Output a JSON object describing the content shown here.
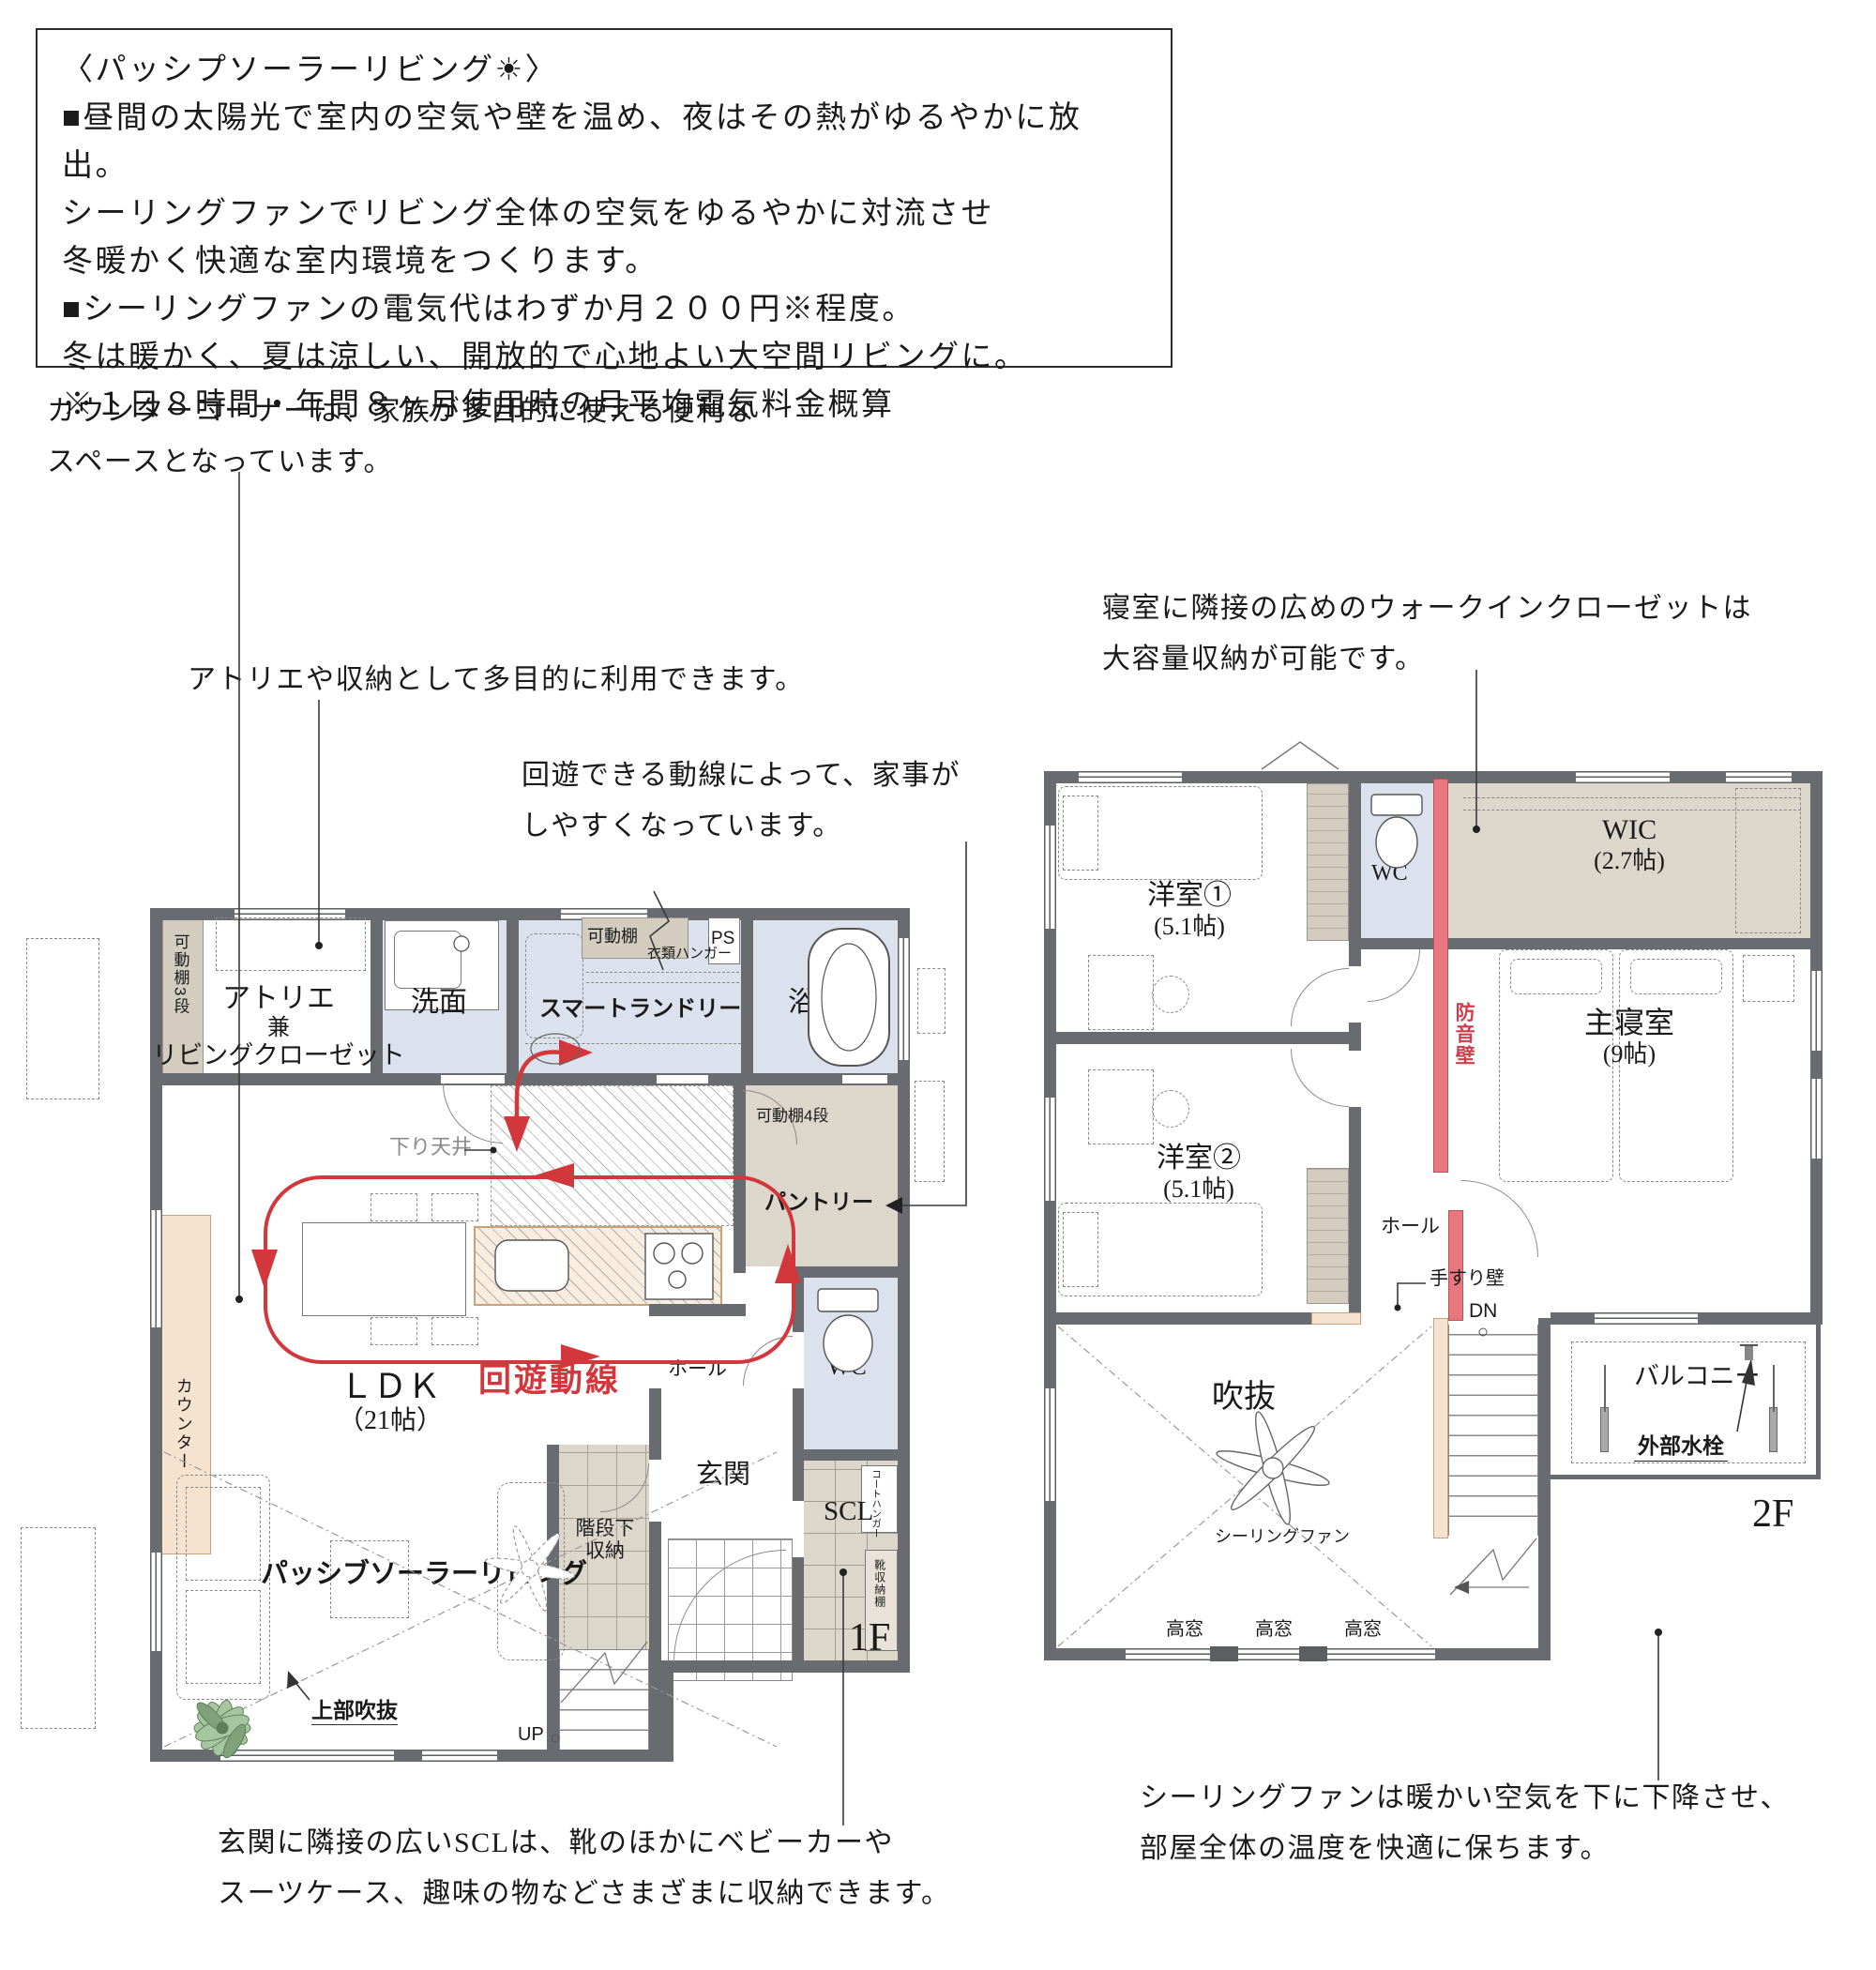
{
  "info_box": {
    "title": "〈パッシプソーラーリビング☀〉",
    "lines": [
      "■昼間の太陽光で室内の空気や壁を温め、夜はその熱がゆるやかに放出。",
      "シーリングファンでリビング全体の空気をゆるやかに対流させ",
      "冬暖かく快適な室内環境をつくります。",
      "■シーリングファンの電気代はわずか月２００円※程度。",
      "冬は暖かく、夏は涼しい、開放的で心地よい大空間リビングに。",
      "※１日８時間・年間８ヶ月使用時の月平均電気料金概算"
    ]
  },
  "annotations": {
    "counter": [
      "カウンターコーナーは、家族が多目的に使える便利な",
      "スペースとなっています。"
    ],
    "atelier": "アトリエや収納として多目的に利用できます。",
    "circulation": [
      "回遊できる動線によって、家事が",
      "しやすくなっています。"
    ],
    "wic": [
      "寝室に隣接の広めのウォークインクローゼットは",
      "大容量収納が可能です。"
    ],
    "scl": [
      "玄関に隣接の広いSCLは、靴のほかにベビーカーや",
      "スーツケース、趣味の物などさまざまに収納できます。"
    ],
    "fan": [
      "シーリングファンは暖かい空気を下に下降させ、",
      "部屋全体の温度を快適に保ちます。"
    ]
  },
  "floor1": {
    "floor_label": "1F",
    "rooms": {
      "atelier": [
        "アトリエ",
        "兼",
        "リビングクローゼット"
      ],
      "washroom": "洗面",
      "laundry": "スマートランドリー",
      "bath": "浴室",
      "pantry": "パントリー",
      "wc": "WC",
      "hall": "ホール",
      "ldk": [
        "ＬＤＫ",
        "（21帖）"
      ],
      "living": "パッシブソーラーリビング",
      "entrance": "玄関",
      "scl": "SCL",
      "stair_storage": [
        "階段下",
        "収納"
      ]
    },
    "labels": {
      "shelf3": "可動棚3段",
      "shelf": "可動棚",
      "hanger": "衣類ハンガー",
      "ps": "PS",
      "shelf4": "可動棚4段",
      "lowered_ceiling": "下り天井",
      "counter": "カウンター",
      "circulation": "回遊動線",
      "void_above": "上部吹抜",
      "up": "UP",
      "coat_hanger": "コートハンガー",
      "shoe_shelf": "靴収納棚"
    }
  },
  "floor2": {
    "floor_label": "2F",
    "rooms": {
      "bedroom1": [
        "洋室①",
        "(5.1帖)"
      ],
      "bedroom2": [
        "洋室②",
        "(5.1帖)"
      ],
      "wc": "WC",
      "wic": [
        "WIC",
        "(2.7帖)"
      ],
      "master": [
        "主寝室",
        "(9帖)"
      ],
      "void": "吹抜",
      "balcony": "バルコニー",
      "hall": "ホール"
    },
    "labels": {
      "soundproof": "防音壁",
      "handrail": "手すり壁",
      "dn": "DN",
      "fan": "シーリングファン",
      "highwindow": "高窓",
      "faucet": "外部水栓"
    }
  },
  "colors": {
    "wall": "#686c70",
    "water_room": "#dbe2ed",
    "storage_tan": "#ddd6cb",
    "counter_peach": "#f6e3cf",
    "circulation_red": "#d2373b",
    "soundproof_red": "#e8767e"
  }
}
